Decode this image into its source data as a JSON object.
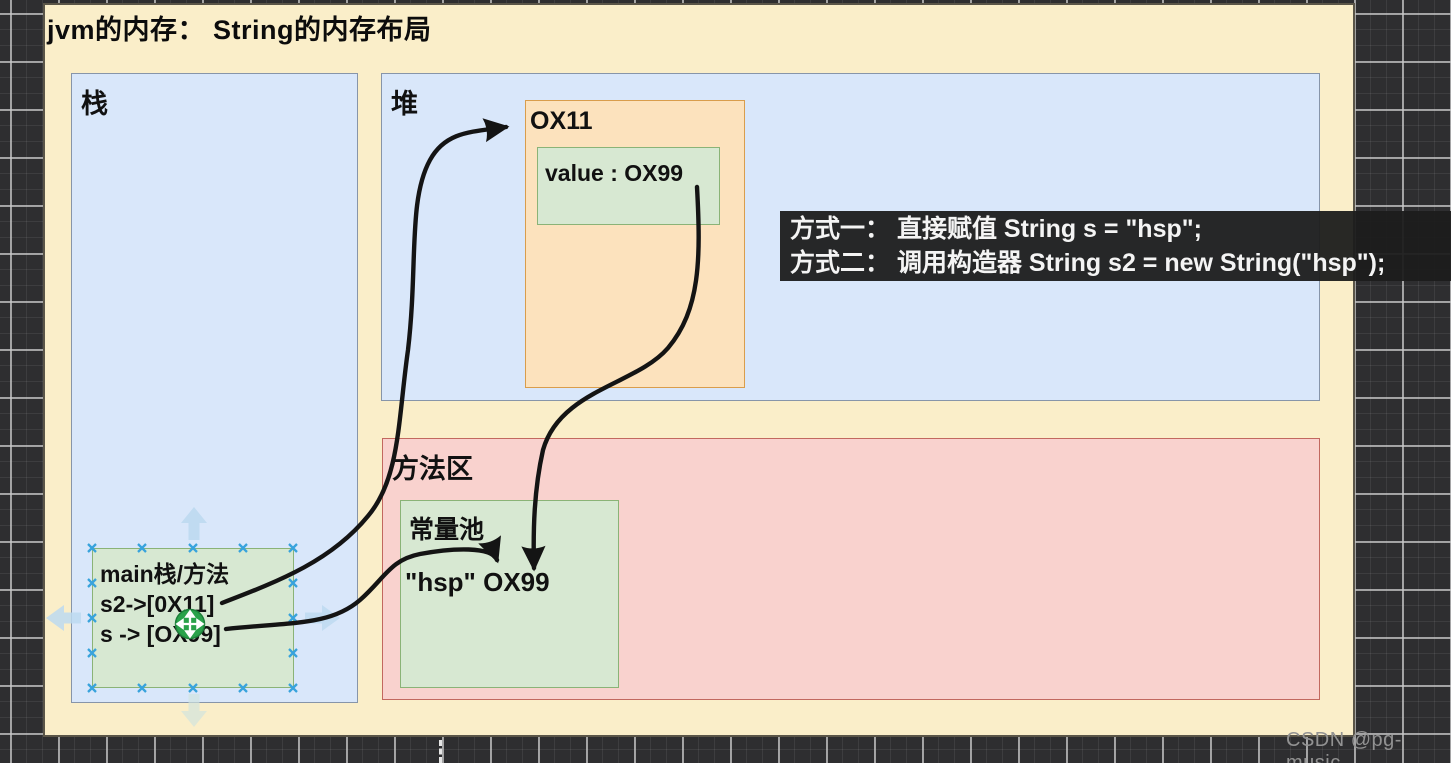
{
  "app": {
    "watermark": "CSDN @pg-music"
  },
  "diagram": {
    "title": "jvm的内存：  String的内存布局",
    "stack": {
      "label": "栈"
    },
    "heap": {
      "label": "堆",
      "object": {
        "address": "OX11",
        "value_field": "value : OX99"
      }
    },
    "method_area": {
      "label": "方法区",
      "constant_pool": {
        "label": "常量池",
        "entry": "\"hsp\" OX99"
      }
    },
    "stack_frame": {
      "line1": "main栈/方法",
      "line2": "s2->[0X11]",
      "line3": "s -> [OX99]"
    },
    "annotation": {
      "line1": "方式一： 直接赋值 String s = \"hsp\";",
      "line2": "方式二： 调用构造器 String s2 = new String(\"hsp\");"
    },
    "colors": {
      "panel_bg": "#faeec9",
      "region_blue": "#d9e7fa",
      "object_orange": "#fce2bd",
      "green_box": "#d7e8d2",
      "method_pink": "#f9d2ce",
      "annotation_bg": "#1c1c1c",
      "selection_handle_blue": "#38a3dc",
      "move_cursor_green": "#2aa24a",
      "connector_black": "#141414"
    }
  }
}
